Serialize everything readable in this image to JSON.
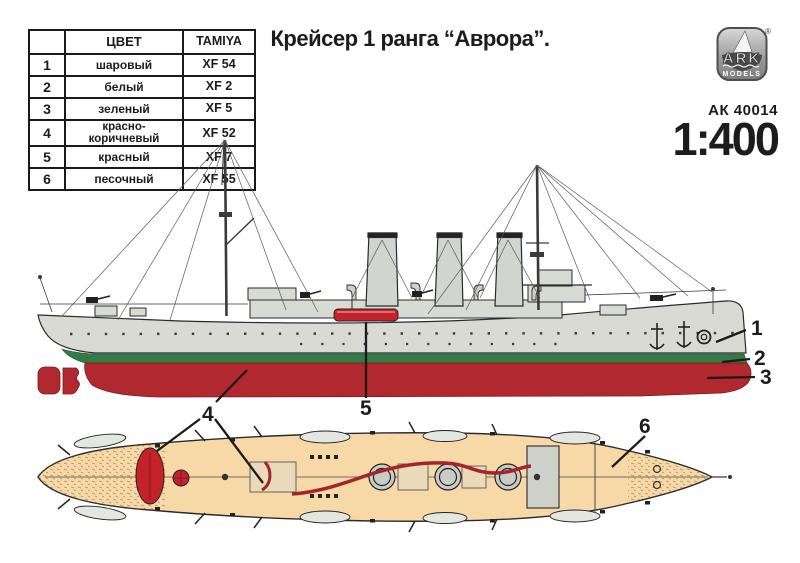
{
  "title": "Крейсер 1 ранга “Аврора”.",
  "brand": {
    "logo_text": "ARK",
    "logo_subtext": "MODELS",
    "registered": "®",
    "sku": "АК 40014",
    "scale": "1:400"
  },
  "color_table": {
    "headers": [
      "",
      "ЦВЕТ",
      "TAMIYA"
    ],
    "rows": [
      {
        "num": "1",
        "color": "шаровый",
        "tamiya": "XF 54"
      },
      {
        "num": "2",
        "color": "белый",
        "tamiya": "XF 2"
      },
      {
        "num": "3",
        "color": "зеленый",
        "tamiya": "XF 5"
      },
      {
        "num": "4",
        "color": "красно-коричневый",
        "tamiya": "XF 52"
      },
      {
        "num": "5",
        "color": "красный",
        "tamiya": "XF 7"
      },
      {
        "num": "6",
        "color": "песочный",
        "tamiya": "XF 55"
      }
    ]
  },
  "callouts": [
    "1",
    "2",
    "3",
    "4",
    "5",
    "6"
  ],
  "colors": {
    "hull_grey": "#d9dad4",
    "stripe_green": "#307b46",
    "underwater_red": "#b1282f",
    "bright_red": "#c4232b",
    "deck_tan": "#f6d9a6",
    "ink": "#1c1c1c"
  }
}
